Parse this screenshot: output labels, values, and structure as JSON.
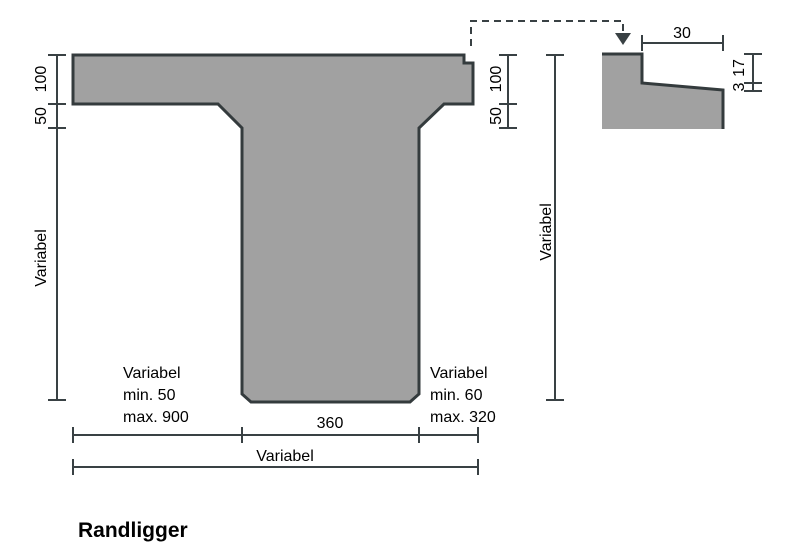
{
  "title": "Randligger",
  "colors": {
    "background": "#ffffff",
    "shape_fill": "#a1a1a1",
    "shape_stroke": "#343b3d",
    "dimension_color": "#394144",
    "text_color": "#000000"
  },
  "main_view": {
    "left_dims": {
      "flange_thickness": "100",
      "haunch_height": "50",
      "web_height": "Variabel"
    },
    "right_dims": {
      "flange_thickness": "100",
      "haunch_height": "50"
    },
    "overall_height": "Variabel",
    "bottom_dims": {
      "web_width": "360",
      "overall_width": "Variabel"
    },
    "left_note": {
      "line1": "Variabel",
      "line2": "min. 50",
      "line3": "max. 900"
    },
    "right_note": {
      "line1": "Variabel",
      "line2": "min. 60",
      "line3": "max. 320"
    }
  },
  "detail_view": {
    "top_width": "30",
    "edge_drop": "17",
    "slope_drop": "3"
  }
}
